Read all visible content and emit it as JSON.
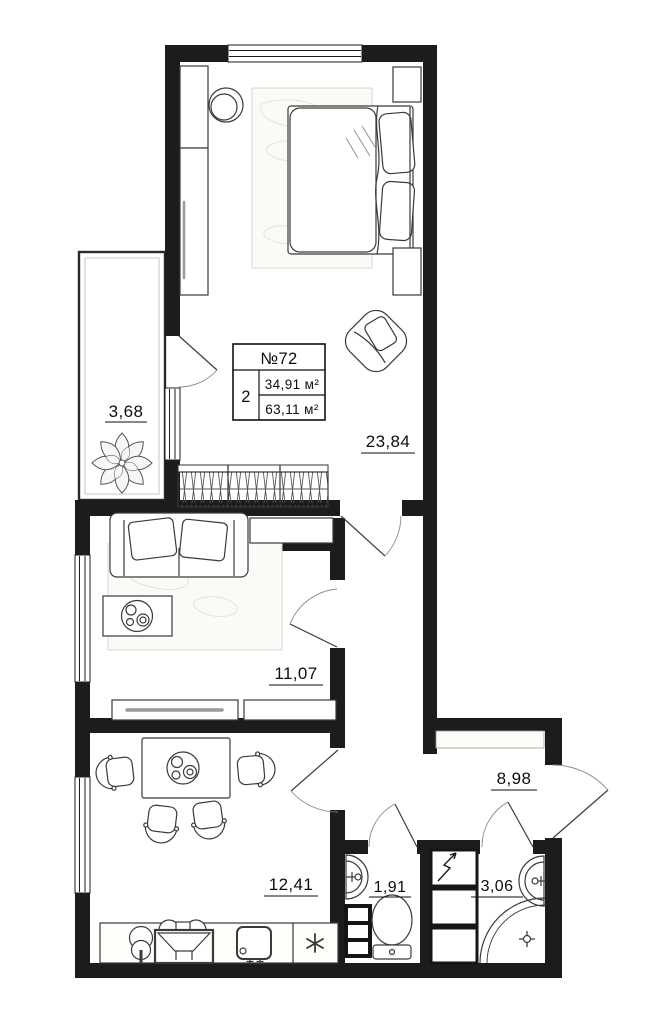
{
  "title": "Apartment floor plan",
  "unit_card": {
    "number": "№72",
    "rooms": "2",
    "living_area": "34,91 м²",
    "total_area": "63,11 м²"
  },
  "room_labels": {
    "balcony": "3,68",
    "bedroom": "23,84",
    "living_room": "11,07",
    "kitchen": "12,41",
    "wc": "1,91",
    "bathroom": "3,06",
    "hallway": "8,98"
  },
  "colors": {
    "wall": "#1c1c1c",
    "furniture_line": "#3a3a3a",
    "paper": "#ffffff"
  },
  "fixtures": [
    "bed",
    "wardrobe",
    "mirror",
    "armchair",
    "hanger-closet",
    "plant",
    "sofa",
    "coffee-table",
    "tv-stand",
    "sideboard",
    "dining-table",
    "chair",
    "kitchen-faucet",
    "stove",
    "kitchen-sink",
    "fridge",
    "wc-sink",
    "towel-rail",
    "toilet",
    "electrical-shaft",
    "bath-sink",
    "shower"
  ]
}
